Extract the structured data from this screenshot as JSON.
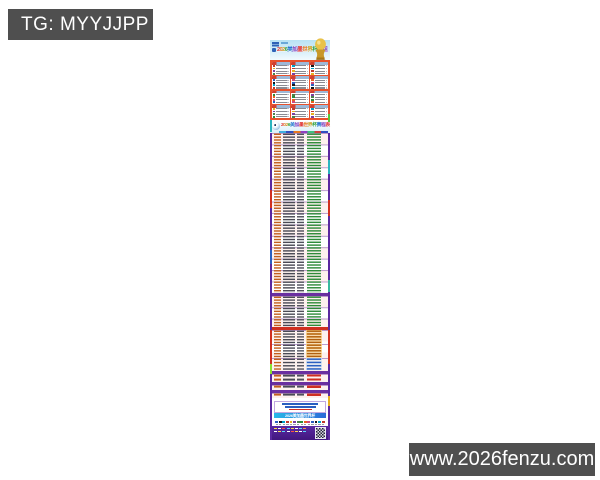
{
  "watermarks": {
    "tg_label": "TG: MYYJJPP",
    "site_url": "www.2026fenzu.com",
    "bg_color": "#4f4f4f",
    "text_color": "#ffffff"
  },
  "poster": {
    "title": "2026美加墨世界杯分组",
    "schedule_title": "2026美加墨世界杯赛程表",
    "footer_title": "2026美加墨世界杯",
    "rainbow": [
      "#e03030",
      "#e87820",
      "#c8a020",
      "#2fa040",
      "#2878d0",
      "#8040c0"
    ],
    "flag_palette": [
      "#c0392b",
      "#2b5fc0",
      "#2e8b3a",
      "#e8b020",
      "#16161a",
      "#e86020",
      "#7b3fa0",
      "#00a0c8",
      "#d04878",
      "#4a8048"
    ],
    "groups": {
      "count": 12,
      "teams_per_group": 4,
      "panel_color": "#e8512c"
    },
    "sections": [
      {
        "kind": "rows",
        "name": "group-stage-matches",
        "rows": 56,
        "height": 160,
        "col4_color": "#2e8b3a",
        "sep_every": 4
      },
      {
        "kind": "divider",
        "height": 3,
        "color": "#6a2fa0"
      },
      {
        "kind": "rows",
        "name": "round-of-32",
        "rows": 11,
        "height": 31,
        "col4_color": "#2e8b3a",
        "sep_every": 4
      },
      {
        "kind": "divider",
        "height": 3,
        "color": "#cf2f20"
      },
      {
        "kind": "rows",
        "name": "round-of-16",
        "rows": 10,
        "height": 28,
        "col4_color": "#b06010",
        "col4_bg": "#f5c878",
        "sep_every": 5
      },
      {
        "kind": "rows",
        "name": "quarter-finals",
        "rows": 4,
        "height": 13,
        "col4_color": "#2b5fc0",
        "col4_bg": "#bcd4f0",
        "sep_every": 4
      },
      {
        "kind": "divider",
        "height": 3,
        "color": "#6a2fa0"
      },
      {
        "kind": "rows",
        "name": "semi-finals",
        "rows": 2,
        "height": 8,
        "col4_color": "#cf2f20",
        "sep_every": 2
      },
      {
        "kind": "divider",
        "height": 3,
        "color": "#6a2fa0"
      },
      {
        "kind": "rows",
        "name": "third-place",
        "rows": 1,
        "height": 5,
        "col4_color": "#cf2f20",
        "sep_every": 1
      },
      {
        "kind": "divider",
        "height": 3,
        "color": "#6a2fa0"
      },
      {
        "kind": "rows",
        "name": "final",
        "rows": 1,
        "height": 5,
        "col4_color": "#cf2f20",
        "sep_every": 1
      }
    ],
    "notes_lines": [
      {
        "width_pct": 72,
        "color": "#2b5fc0"
      },
      {
        "width_pct": 62,
        "color": "#2b5fc0"
      },
      {
        "width_pct": 46,
        "color": "#d03020"
      }
    ],
    "accents": [
      {
        "side": "left",
        "top": 80,
        "height": 12,
        "color": "#2bb5c0"
      },
      {
        "side": "left",
        "top": 150,
        "height": 18,
        "color": "#d03020"
      },
      {
        "side": "left",
        "top": 210,
        "height": 14,
        "color": "#2b5fc0"
      },
      {
        "side": "left",
        "top": 290,
        "height": 34,
        "color": "#d03020"
      },
      {
        "side": "left",
        "top": 324,
        "height": 10,
        "color": "#8ae030"
      },
      {
        "side": "right",
        "top": 74,
        "height": 8,
        "color": "#58c838"
      },
      {
        "side": "right",
        "top": 120,
        "height": 14,
        "color": "#2bb5c0"
      },
      {
        "side": "right",
        "top": 160,
        "height": 16,
        "color": "#d03020"
      },
      {
        "side": "right",
        "top": 240,
        "height": 12,
        "color": "#38b8a0"
      },
      {
        "side": "right",
        "top": 290,
        "height": 34,
        "color": "#d03020"
      },
      {
        "side": "right",
        "top": 356,
        "height": 10,
        "color": "#e8b020"
      }
    ],
    "flags_count": 14,
    "footer_dashes": [
      [
        "#ffd84a",
        "#ffffff",
        "#ff5040",
        "#58d8ff",
        "#ffd84a",
        "#ffffff",
        "#58d8ff",
        "#ff9040"
      ],
      [
        "#ffffff",
        "#ffd84a",
        "#58d8ff",
        "#ffffff",
        "#ff5040",
        "#ffd84a",
        "#ffffff",
        "#58d8ff"
      ]
    ],
    "colors": {
      "schedule_accent": "#6a2fa0",
      "group_panel": "#e8512c",
      "header_sky": "#b9e2f4",
      "footer_purple": "#5a2aa2",
      "trophy_gold": "#e0b030"
    }
  }
}
